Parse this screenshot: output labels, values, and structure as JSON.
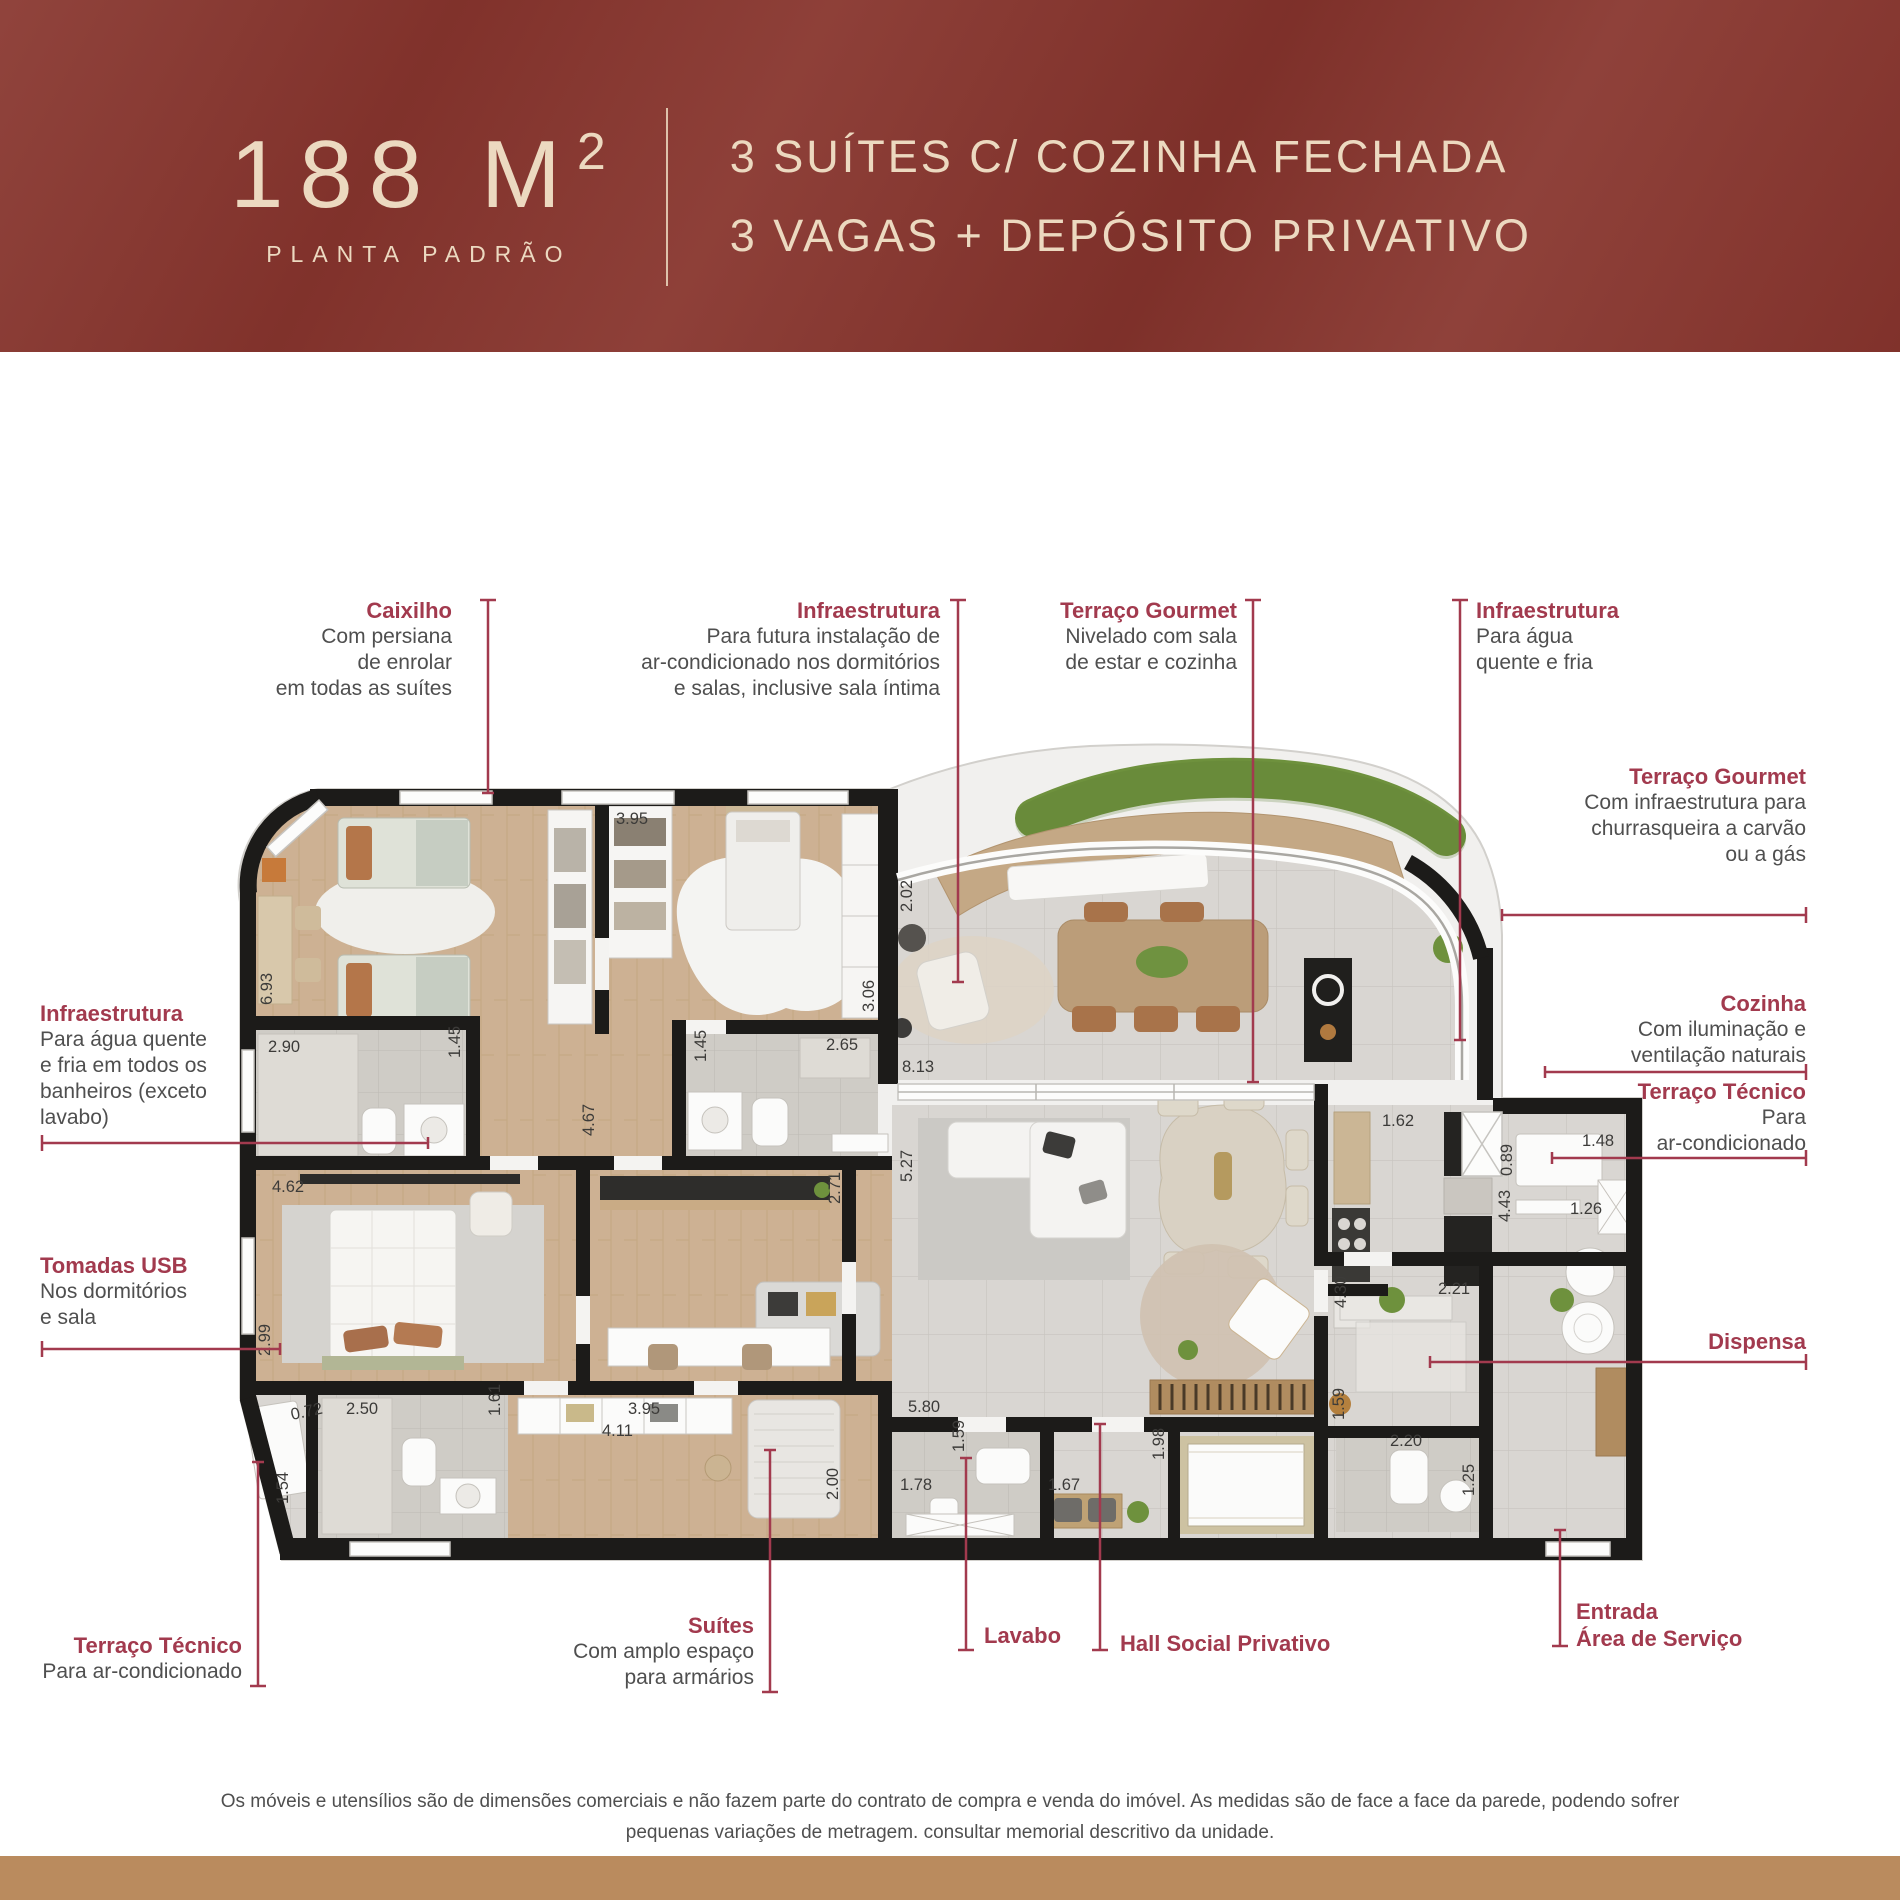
{
  "header": {
    "area_value": "188 M",
    "area_sup": "2",
    "area_label": "PLANTA PADRÃO",
    "feature_line1": "3 SUÍTES C/ COZINHA FECHADA",
    "feature_line2": "3 VAGAS + DEPÓSITO PRIVATIVO"
  },
  "callouts": {
    "caixilho": {
      "title": "Caixilho",
      "l1": "Com persiana",
      "l2": "de enrolar",
      "l3": "em todas as suítes"
    },
    "infra_top": {
      "title": "Infraestrutura",
      "l1": "Para futura instalação de",
      "l2": "ar-condicionado nos dormitórios",
      "l3": "e salas, inclusive sala íntima"
    },
    "terraco_gourmet_top": {
      "title": "Terraço Gourmet",
      "l1": "Nivelado com sala",
      "l2": "de estar e cozinha"
    },
    "infra_top_right": {
      "title": "Infraestrutura",
      "l1": "Para água",
      "l2": "quente e fria"
    },
    "terraco_gourmet_right": {
      "title": "Terraço Gourmet",
      "l1": "Com infraestrutura para",
      "l2": "churrasqueira a carvão",
      "l3": "ou a gás"
    },
    "cozinha": {
      "title": "Cozinha",
      "l1": "Com iluminação e",
      "l2": "ventilação naturais"
    },
    "terraco_tecnico_right": {
      "title": "Terraço Técnico",
      "l1": "Para",
      "l2": "ar-condicionado"
    },
    "dispensa": {
      "title": "Dispensa"
    },
    "infra_left": {
      "title": "Infraestrutura",
      "l1": "Para água quente",
      "l2": "e fria em todos os",
      "l3": "banheiros (exceto",
      "l4": "lavabo)"
    },
    "tomadas_usb": {
      "title": "Tomadas USB",
      "l1": "Nos dormitórios",
      "l2": "e sala"
    },
    "terraco_tecnico_left": {
      "title": "Terraço Técnico",
      "l1": "Para ar-condicionado"
    },
    "suites": {
      "title": "Suítes",
      "l1": "Com amplo espaço",
      "l2": "para armários"
    },
    "lavabo": {
      "title": "Lavabo"
    },
    "hall": {
      "title": "Hall Social Privativo"
    },
    "entrada": {
      "title": "Entrada",
      "l1": "Área de Serviço"
    }
  },
  "plan": {
    "measurements": [
      {
        "v": "6.93"
      },
      {
        "v": "2.90"
      },
      {
        "v": "1.45"
      },
      {
        "v": "3.95"
      },
      {
        "v": "1.45"
      },
      {
        "v": "2.65"
      },
      {
        "v": "3.06"
      },
      {
        "v": "5.27"
      },
      {
        "v": "2.02"
      },
      {
        "v": "8.13"
      },
      {
        "v": "1.62"
      },
      {
        "v": "4.67"
      },
      {
        "v": "4.62"
      },
      {
        "v": "2.99"
      },
      {
        "v": "2.50"
      },
      {
        "v": "1.61"
      },
      {
        "v": "0.72"
      },
      {
        "v": "1.54"
      },
      {
        "v": "3.95"
      },
      {
        "v": "4.11"
      },
      {
        "v": "2.71"
      },
      {
        "v": "2.00"
      },
      {
        "v": "5.80"
      },
      {
        "v": "1.59"
      },
      {
        "v": "1.78"
      },
      {
        "v": "1.98"
      },
      {
        "v": "1.67"
      },
      {
        "v": "4.30"
      },
      {
        "v": "2.21"
      },
      {
        "v": "1.59"
      },
      {
        "v": "2.20"
      },
      {
        "v": "1.25"
      },
      {
        "v": "0.89"
      },
      {
        "v": "1.48"
      },
      {
        "v": "4.43"
      },
      {
        "v": "1.26"
      }
    ]
  },
  "disclaimer": {
    "line1": "Os móveis e utensílios são de dimensões comerciais e não fazem parte do contrato de compra e venda do imóvel. As medidas são de face a face da parede, podendo sofrer",
    "line2": "pequenas variações de metragem. consultar memorial descritivo da unidade."
  },
  "colors": {
    "header_bg": "#88362f",
    "header_text": "#ecd9c0",
    "accent_red": "#a23a4e",
    "wall": "#1c1b19",
    "wood_floor": "#cdb193",
    "tile_floor": "#d9d6d2",
    "planter_green": "#6e913d",
    "footer_band": "#ba8b5e"
  }
}
